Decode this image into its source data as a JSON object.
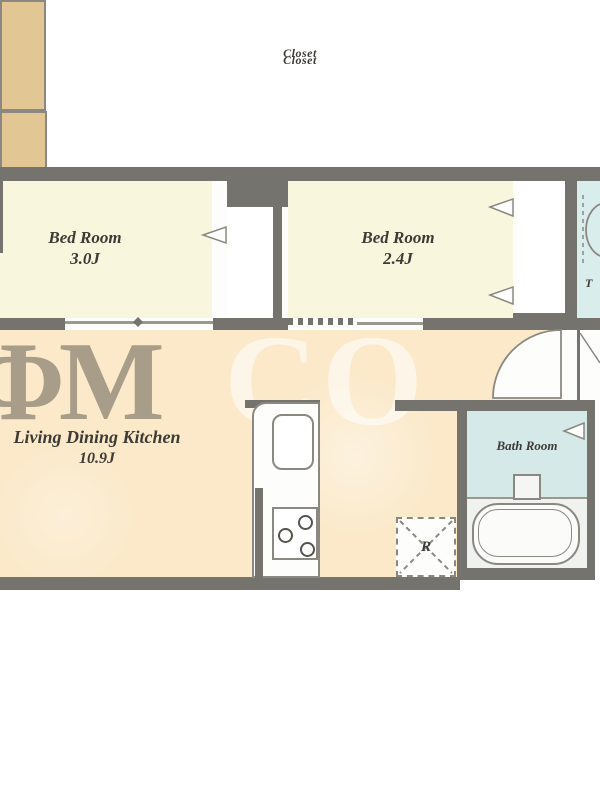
{
  "plan": {
    "rooms": {
      "bedroom1": {
        "name": "Bed Room",
        "area": "3.0J"
      },
      "bedroom2": {
        "name": "Bed Room",
        "area": "2.4J"
      },
      "closet1": {
        "name": "Closet"
      },
      "closet2": {
        "name": "Closet"
      },
      "ldk": {
        "name": "Living Dining Kitchen",
        "area": "10.9J"
      },
      "bathroom": {
        "name": "Bath Room"
      },
      "toilet": {
        "visible_fragment": "T"
      }
    },
    "fixtures": {
      "refrigerator": {
        "label": "R"
      }
    },
    "watermark": {
      "dark_fragment": "ΦM",
      "light_fragment": "CO"
    },
    "colors": {
      "wall": "#75736e",
      "bedroom_floor": "#f8f6dc",
      "ldk_floor": "#fbe9c9",
      "closet_fill": "#e2c693",
      "bath_floor": "#d5e9e9",
      "toilet_floor": "#d9eded",
      "outline": "#8a8880"
    }
  }
}
